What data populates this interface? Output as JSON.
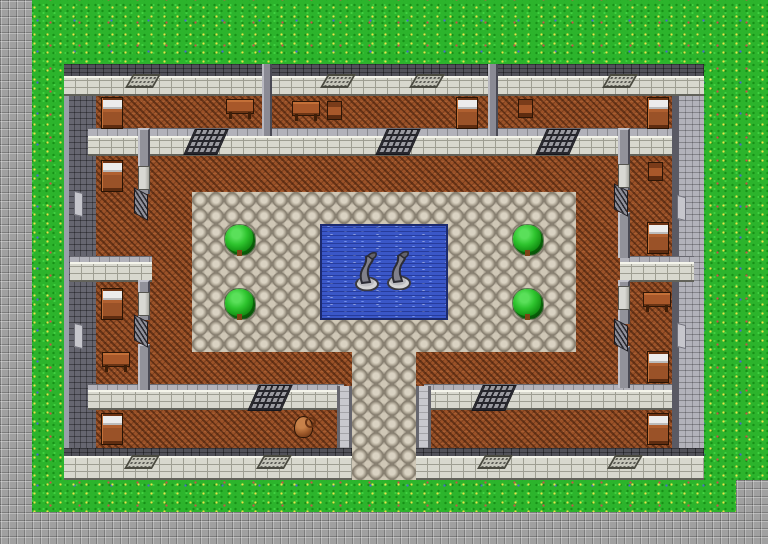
{
  "scene": {
    "name": "top-down-rpg-castle-courtyard-map",
    "viewport_w": 768,
    "viewport_h": 544,
    "tile_size": 32
  },
  "palette": {
    "grass": "#2cb42c",
    "stone": "#a0a0a0",
    "cobble": "#9c9484",
    "cobble-light": "#d9d2c2",
    "wood": "#9b5228",
    "water": "#3a57c8",
    "water-deep": "#1c2a6e",
    "wall-face": "#d8d8ce",
    "wall-top": "#52525a",
    "wall-west": "#666670",
    "wall-east": "#b2b2ba",
    "bush": "#2ec42e"
  },
  "terrain": [
    {
      "t": "stone",
      "x": 0,
      "y": 0,
      "w": 32,
      "h": 544
    },
    {
      "t": "stone",
      "x": 0,
      "y": 512,
      "w": 768,
      "h": 32
    },
    {
      "t": "stone",
      "x": 736,
      "y": 480,
      "w": 32,
      "h": 32
    },
    {
      "t": "wood",
      "x": 64,
      "y": 64,
      "w": 640,
      "h": 416
    },
    {
      "t": "cobble",
      "x": 192,
      "y": 192,
      "w": 384,
      "h": 160
    },
    {
      "t": "cobble",
      "x": 352,
      "y": 352,
      "w": 64,
      "h": 128
    },
    {
      "t": "water",
      "x": 320,
      "y": 224,
      "w": 128,
      "h": 96
    }
  ],
  "walls": [
    {
      "t": "hwall",
      "x": 64,
      "y": 64,
      "w": 640,
      "h": 32,
      "cap": 12
    },
    {
      "t": "vwall_dark",
      "x": 64,
      "y": 96,
      "w": 32,
      "h": 352
    },
    {
      "t": "vwall_light",
      "x": 672,
      "y": 96,
      "w": 32,
      "h": 352
    },
    {
      "t": "hwall",
      "x": 88,
      "y": 128,
      "w": 584,
      "h": 28,
      "cap": 8,
      "light": true
    },
    {
      "t": "hwall",
      "x": 70,
      "y": 256,
      "w": 82,
      "h": 26,
      "cap": 6,
      "light": true
    },
    {
      "t": "hwall",
      "x": 620,
      "y": 256,
      "w": 74,
      "h": 26,
      "cap": 6,
      "light": true
    },
    {
      "t": "hwall",
      "x": 88,
      "y": 384,
      "w": 256,
      "h": 26,
      "cap": 6,
      "light": true
    },
    {
      "t": "hwall",
      "x": 424,
      "y": 384,
      "w": 248,
      "h": 26,
      "cap": 6,
      "light": true
    },
    {
      "t": "vthin",
      "x": 138,
      "y": 128,
      "w": 12,
      "h": 66
    },
    {
      "t": "vthin",
      "x": 138,
      "y": 280,
      "w": 12,
      "h": 40
    },
    {
      "t": "vthin",
      "x": 138,
      "y": 344,
      "w": 12,
      "h": 46
    },
    {
      "t": "vthin",
      "x": 618,
      "y": 128,
      "w": 12,
      "h": 62
    },
    {
      "t": "vthin",
      "x": 618,
      "y": 212,
      "w": 12,
      "h": 46
    },
    {
      "t": "vthin",
      "x": 618,
      "y": 280,
      "w": 12,
      "h": 44
    },
    {
      "t": "vthin",
      "x": 618,
      "y": 346,
      "w": 12,
      "h": 42
    },
    {
      "t": "divider",
      "x": 262,
      "y": 64,
      "w": 10,
      "h": 72
    },
    {
      "t": "divider",
      "x": 488,
      "y": 64,
      "w": 10,
      "h": 72
    },
    {
      "t": "vflank",
      "x": 337,
      "y": 386,
      "w": 15,
      "h": 68
    },
    {
      "t": "vflank",
      "x": 416,
      "y": 386,
      "w": 15,
      "h": 68
    },
    {
      "t": "hwall",
      "x": 64,
      "y": 448,
      "w": 288,
      "h": 32,
      "cap": 8
    },
    {
      "t": "hwall",
      "x": 416,
      "y": 448,
      "w": 288,
      "h": 32,
      "cap": 8
    }
  ],
  "objects": [
    {
      "t": "grate_lg",
      "x": 189,
      "y": 129
    },
    {
      "t": "grate_lg",
      "x": 381,
      "y": 129
    },
    {
      "t": "grate_lg",
      "x": 541,
      "y": 129
    },
    {
      "t": "grate_lg",
      "x": 253,
      "y": 385
    },
    {
      "t": "grate_lg",
      "x": 477,
      "y": 385
    },
    {
      "t": "grate_sm",
      "x": 134,
      "y": 191
    },
    {
      "t": "grate_sm",
      "x": 134,
      "y": 318
    },
    {
      "t": "grate_sm",
      "x": 614,
      "y": 187
    },
    {
      "t": "grate_sm",
      "x": 614,
      "y": 322
    },
    {
      "t": "vent",
      "x": 129,
      "y": 74
    },
    {
      "t": "vent",
      "x": 324,
      "y": 74
    },
    {
      "t": "vent",
      "x": 413,
      "y": 74
    },
    {
      "t": "vent",
      "x": 606,
      "y": 74
    },
    {
      "t": "vent",
      "x": 128,
      "y": 455
    },
    {
      "t": "vent",
      "x": 260,
      "y": 455
    },
    {
      "t": "vent",
      "x": 481,
      "y": 455
    },
    {
      "t": "vent",
      "x": 611,
      "y": 455
    },
    {
      "t": "door",
      "x": 138,
      "y": 166
    },
    {
      "t": "door",
      "x": 138,
      "y": 292
    },
    {
      "t": "door",
      "x": 618,
      "y": 164
    },
    {
      "t": "door",
      "x": 618,
      "y": 286
    },
    {
      "t": "deco",
      "x": 74,
      "y": 192
    },
    {
      "t": "deco",
      "x": 74,
      "y": 324
    },
    {
      "t": "deco",
      "x": 677,
      "y": 196
    },
    {
      "t": "deco",
      "x": 677,
      "y": 324
    },
    {
      "t": "bed",
      "x": 101,
      "y": 97
    },
    {
      "t": "bed",
      "x": 456,
      "y": 97
    },
    {
      "t": "bed",
      "x": 647,
      "y": 97
    },
    {
      "t": "bed",
      "x": 101,
      "y": 160
    },
    {
      "t": "bed",
      "x": 647,
      "y": 222
    },
    {
      "t": "bed",
      "x": 101,
      "y": 288
    },
    {
      "t": "bed",
      "x": 647,
      "y": 351
    },
    {
      "t": "bed",
      "x": 101,
      "y": 413
    },
    {
      "t": "bed",
      "x": 647,
      "y": 413
    },
    {
      "t": "table",
      "x": 226,
      "y": 99
    },
    {
      "t": "table",
      "x": 292,
      "y": 101
    },
    {
      "t": "table",
      "x": 643,
      "y": 292
    },
    {
      "t": "table",
      "x": 102,
      "y": 352
    },
    {
      "t": "chair",
      "x": 327,
      "y": 101
    },
    {
      "t": "chair",
      "x": 518,
      "y": 99
    },
    {
      "t": "chair",
      "x": 648,
      "y": 162
    },
    {
      "t": "pot",
      "x": 294,
      "y": 416
    },
    {
      "t": "bush",
      "x": 224,
      "y": 224
    },
    {
      "t": "bush",
      "x": 224,
      "y": 288
    },
    {
      "t": "bush",
      "x": 512,
      "y": 224
    },
    {
      "t": "bush",
      "x": 512,
      "y": 288
    },
    {
      "t": "statue",
      "x": 354,
      "y": 251
    },
    {
      "t": "statue",
      "x": 386,
      "y": 250
    }
  ]
}
